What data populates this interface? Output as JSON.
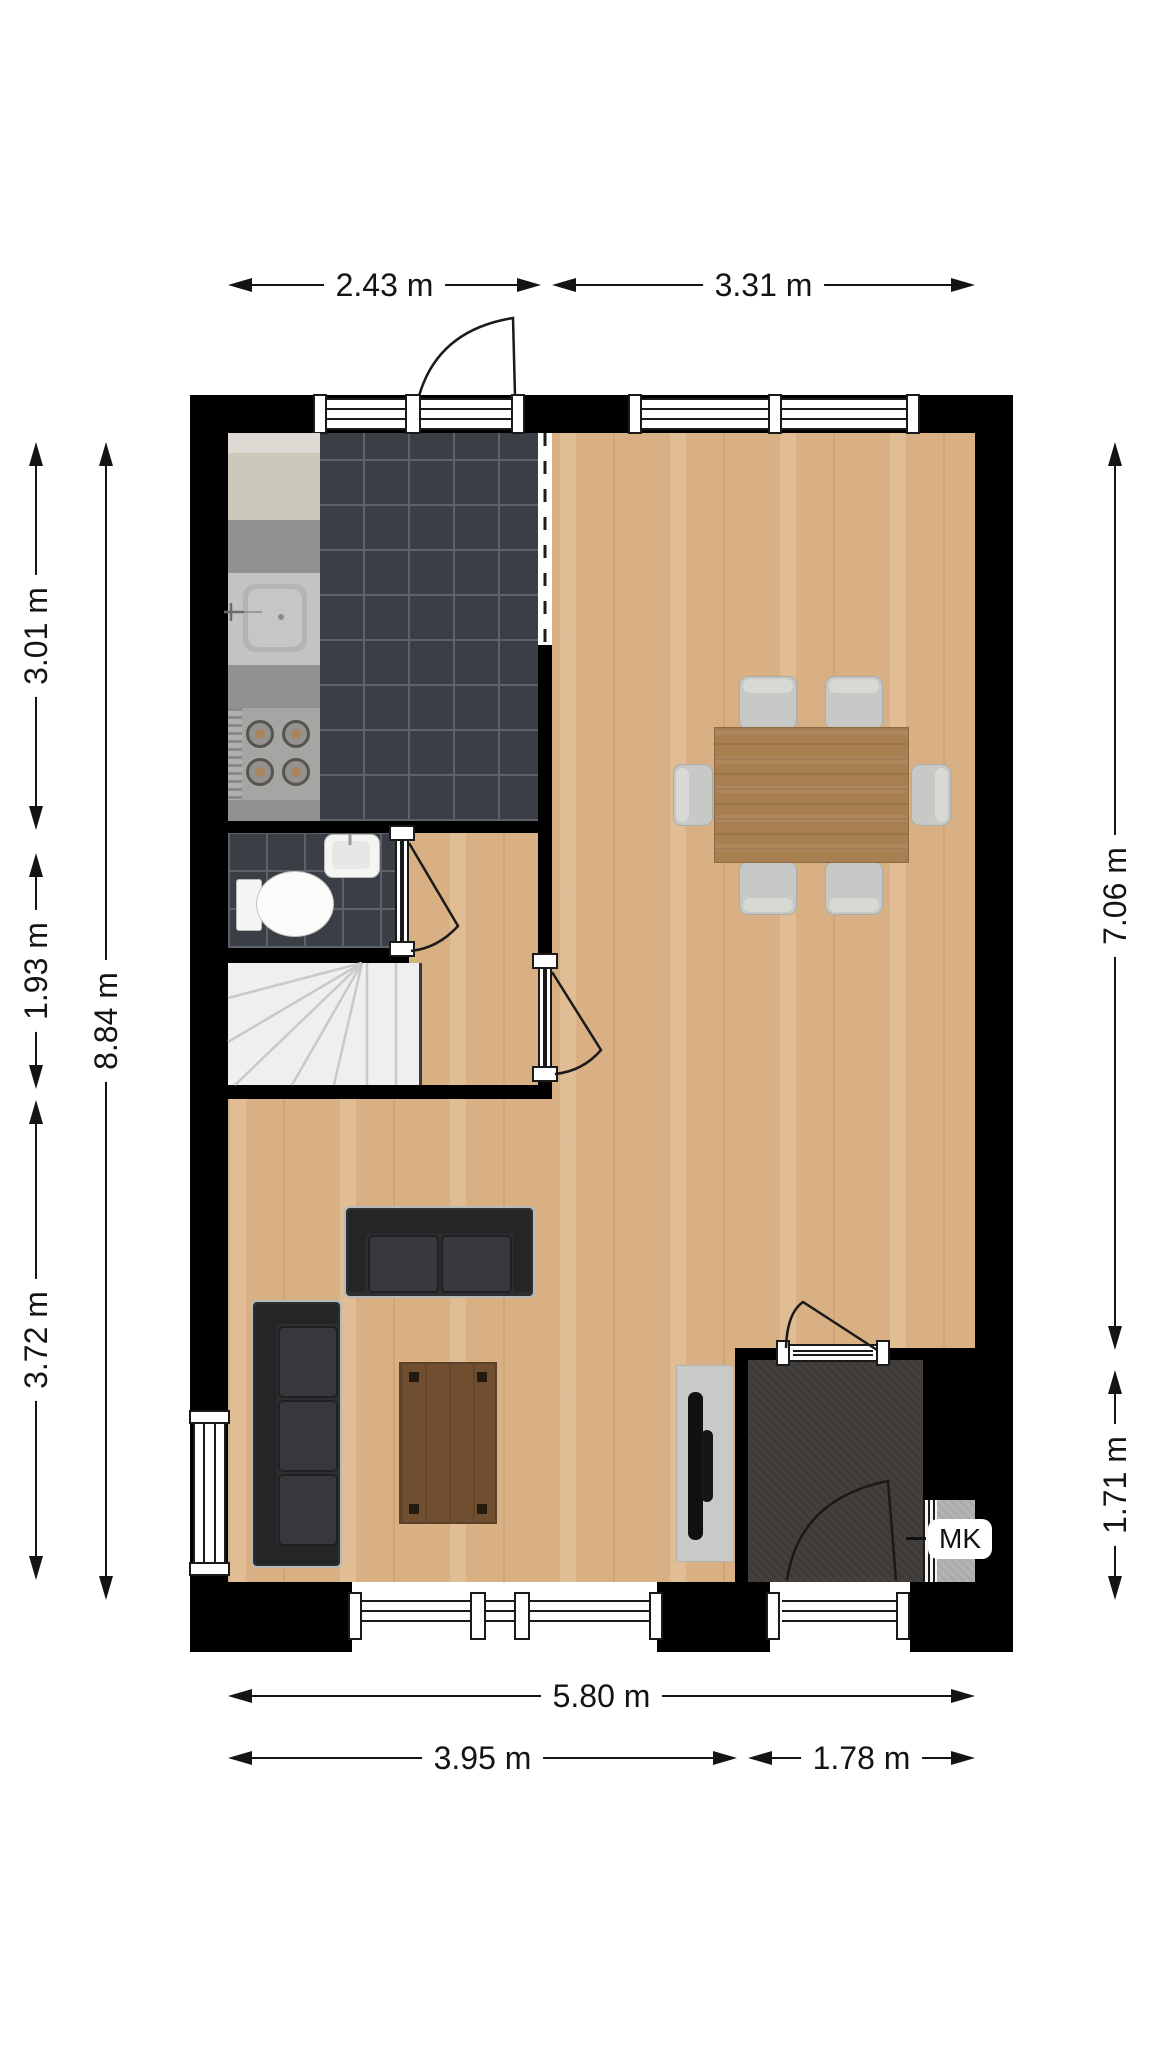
{
  "dimensions": {
    "top": [
      {
        "label": "2.43 m"
      },
      {
        "label": "3.31 m"
      }
    ],
    "left": [
      {
        "label": "3.01 m"
      },
      {
        "label": "1.93 m"
      },
      {
        "label": "3.72 m"
      }
    ],
    "left_total": {
      "label": "8.84 m"
    },
    "right": [
      {
        "label": "7.06 m"
      },
      {
        "label": "1.71 m"
      }
    ],
    "bottom_total": {
      "label": "5.80 m"
    },
    "bottom": [
      {
        "label": "3.95 m"
      },
      {
        "label": "1.78 m"
      }
    ]
  },
  "labels": {
    "meter_cupboard": "MK"
  },
  "colors": {
    "wall": "#000000",
    "wood_floor": "#d9b083",
    "kitchen_tile": "#3a3f45",
    "tile_grout": "#5d6268",
    "hall_floor": "#3e3a37",
    "stairs": "#efefef",
    "counter_gray": "#8f9193",
    "cabinet_beige": "#ccc8ba",
    "sofa_dark": "#2c2e30",
    "dining_table_wood": "#a87f50",
    "coffee_table_wood": "#6f4f30",
    "chair_gray": "#c6c9c5",
    "dimension_text": "#141414"
  }
}
